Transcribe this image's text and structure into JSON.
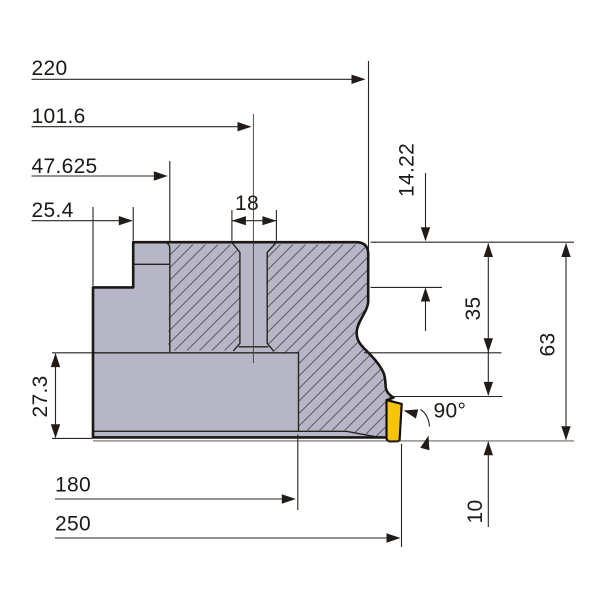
{
  "drawing": {
    "title": "Face milling cutter side cross-section with dimensions",
    "dimensions": {
      "d220": "220",
      "d101_6": "101.6",
      "d47_625": "47.625",
      "d25_4": "25.4",
      "d18": "18",
      "d14_22": "14.22",
      "d35": "35",
      "d63": "63",
      "d27_3": "27.3",
      "d10": "10",
      "d180": "180",
      "d250": "250",
      "angle90": "90°"
    },
    "colors": {
      "background": "#ffffff",
      "body_fill": "#b6b6c6",
      "insert_fill": "#f6c50a",
      "outline": "#1d1815",
      "dimension_lines": "#2a2420",
      "hatch_lines": "#5e5965"
    }
  }
}
